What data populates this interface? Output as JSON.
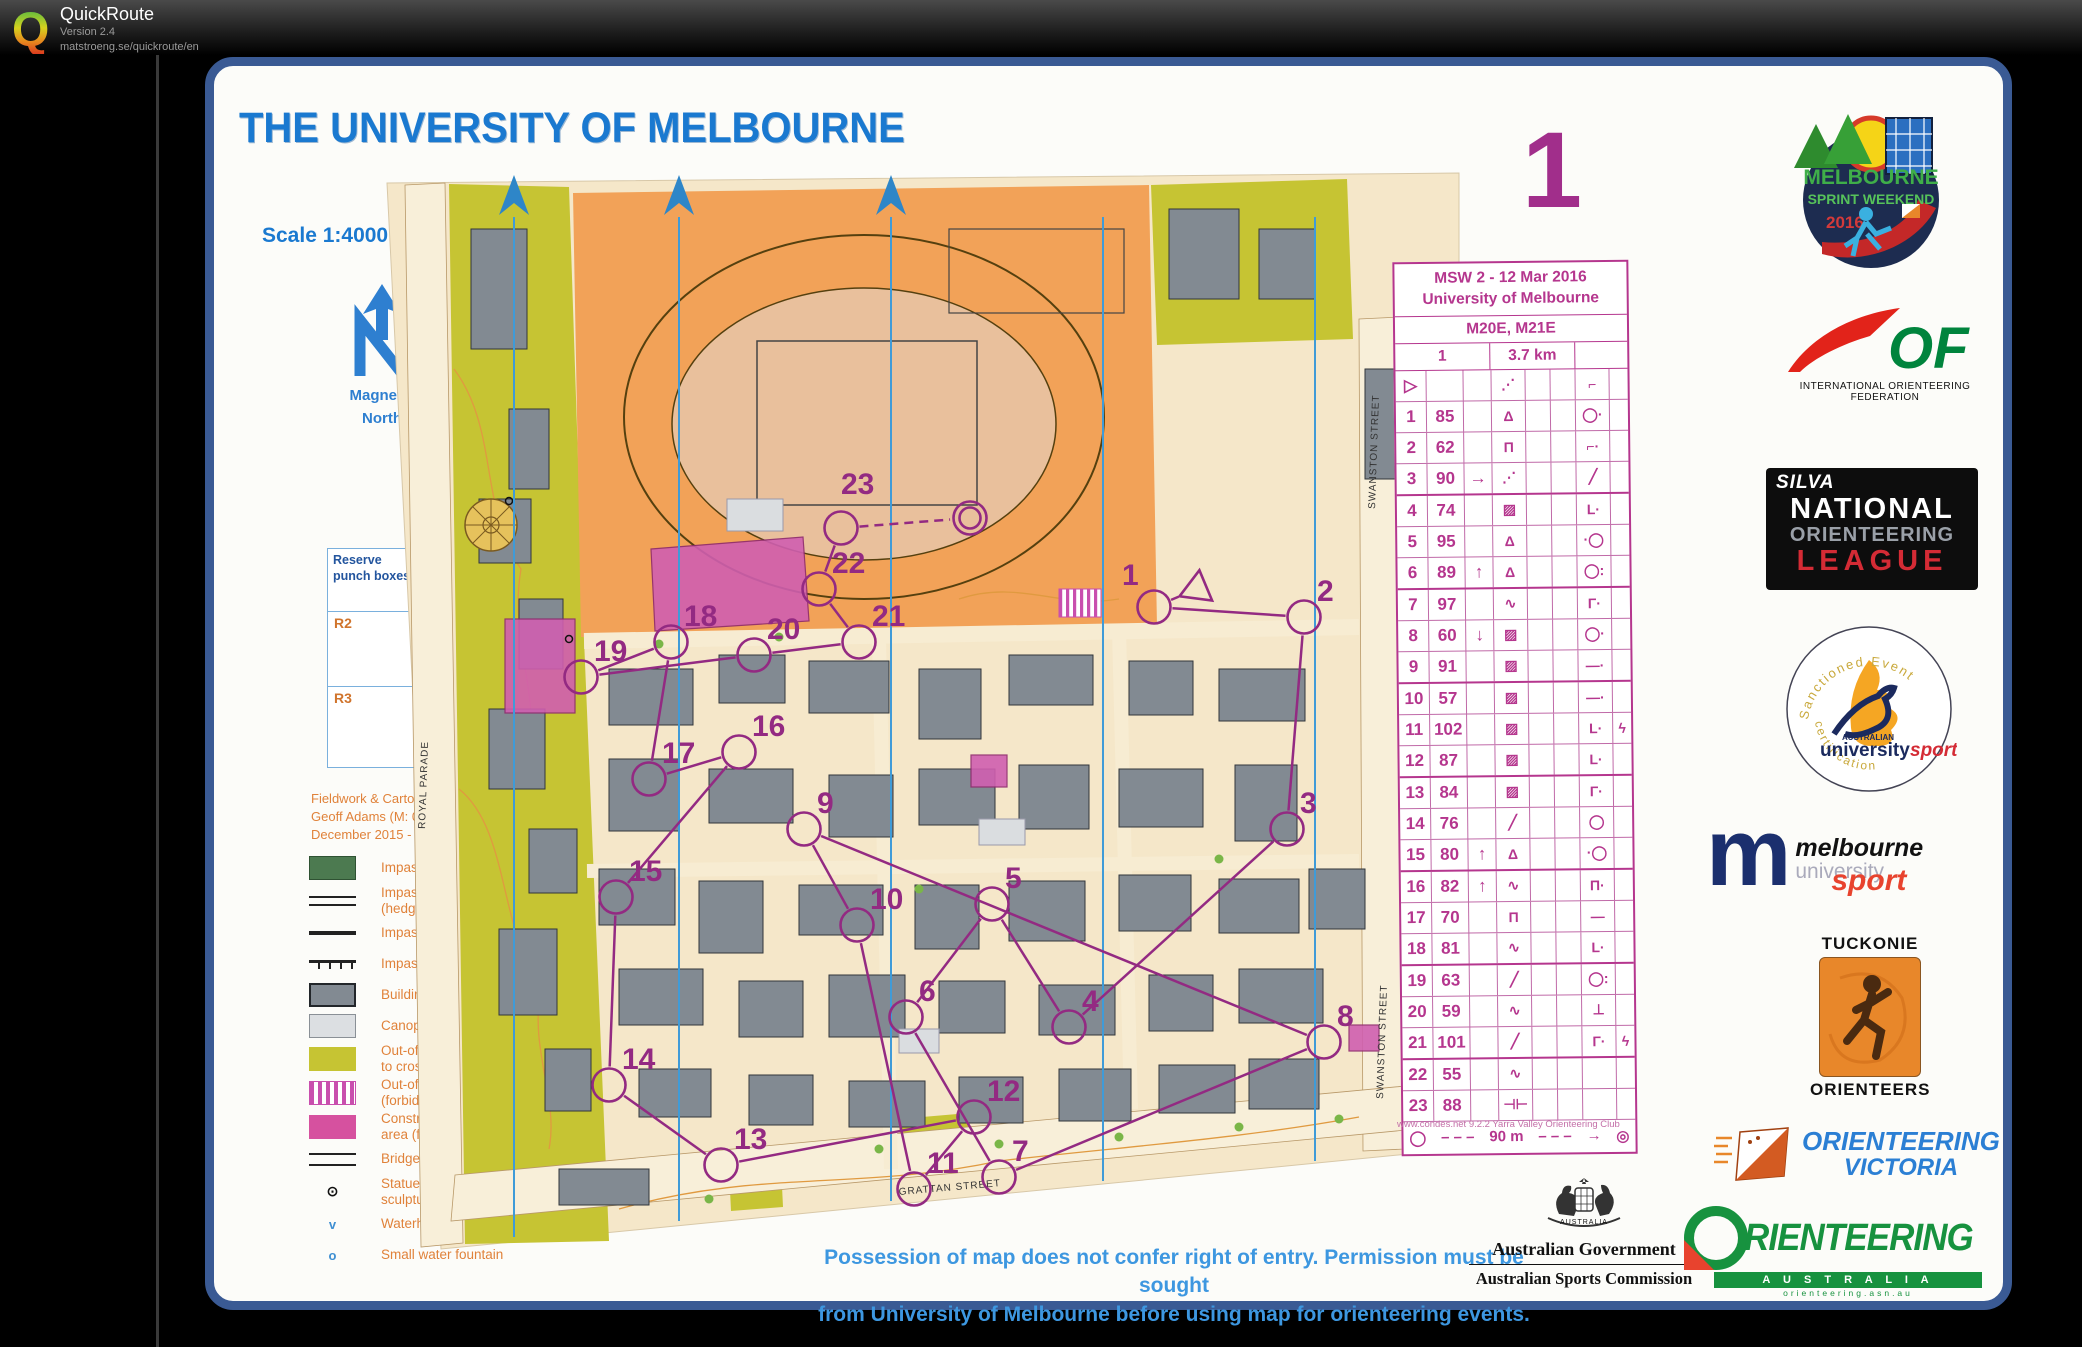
{
  "app": {
    "name": "QuickRoute",
    "version": "Version 2.4",
    "url": "matstroeng.se/quickroute/en",
    "logo_letter": "Q"
  },
  "map": {
    "title": "THE UNIVERSITY OF MELBOURNE",
    "scale": "Scale 1:4000",
    "contour": "Contour Interval 2m",
    "course_number": "1",
    "north": {
      "line1": "Magnetic",
      "line2": "North"
    },
    "scale_bar": {
      "ticks": [
        "0",
        "50",
        "100",
        "150"
      ]
    },
    "punch_box": {
      "title": "Reserve punch boxes",
      "slots": [
        "R2",
        "R3"
      ]
    },
    "credits": [
      "Fieldwork & Cartography",
      "Geoff Adams (M: 0418 587 941)",
      "December 2015 - March 2016"
    ],
    "legend": [
      {
        "symbol": "impassable-vegetation",
        "label": "Impassable vegetation"
      },
      {
        "symbol": "impassable-vegetation-hedge",
        "label": "Impassable vegetation (hedge)"
      },
      {
        "symbol": "impassable-wall",
        "label": "Impassable wall"
      },
      {
        "symbol": "impassable-fence",
        "label": "Impassable fence"
      },
      {
        "symbol": "building",
        "label": "Building (not passable)"
      },
      {
        "symbol": "canopy",
        "label": "Canopy (passable)"
      },
      {
        "symbol": "out-of-bounds",
        "label": "Out-of-bounds (forbidden to cross)"
      },
      {
        "symbol": "out-of-bounds-area",
        "label": "Out-of-bounds area (forbidden to enter)"
      },
      {
        "symbol": "construction",
        "label": "Construction or closed area (forbidden to enter)"
      },
      {
        "symbol": "bridge",
        "label": "Bridge"
      },
      {
        "symbol": "statue",
        "label": "Statue, monument, sculpture"
      },
      {
        "symbol": "waterhole",
        "label": "Waterhole"
      },
      {
        "symbol": "fountain",
        "label": "Small water fountain"
      }
    ],
    "streets": {
      "royal": "ROYAL PARADE",
      "swanston": "SWANSTON STREET",
      "grattan": "GRATTAN STREET"
    },
    "notice": {
      "line1": "Possession of map does not confer right of entry. Permission must be sought",
      "line2": "from University of Melbourne before using map for orienteering events."
    },
    "course": {
      "color": "#932a82",
      "points": [
        {
          "t": "start",
          "x": 838,
          "y": 420
        },
        {
          "t": "c",
          "n": "1",
          "x": 795,
          "y": 438,
          "lx": -32,
          "ly": -22
        },
        {
          "t": "c",
          "n": "2",
          "x": 945,
          "y": 448
        },
        {
          "t": "c",
          "n": "3",
          "x": 928,
          "y": 660
        },
        {
          "t": "c",
          "n": "4",
          "x": 710,
          "y": 858
        },
        {
          "t": "c",
          "n": "5",
          "x": 633,
          "y": 735
        },
        {
          "t": "c",
          "n": "6",
          "x": 547,
          "y": 848
        },
        {
          "t": "c",
          "n": "7",
          "x": 640,
          "y": 1008
        },
        {
          "t": "c",
          "n": "8",
          "x": 965,
          "y": 873
        },
        {
          "t": "c",
          "n": "9",
          "x": 445,
          "y": 660
        },
        {
          "t": "c",
          "n": "10",
          "x": 498,
          "y": 756
        },
        {
          "t": "c",
          "n": "11",
          "x": 555,
          "y": 1020
        },
        {
          "t": "c",
          "n": "12",
          "x": 615,
          "y": 948
        },
        {
          "t": "c",
          "n": "13",
          "x": 362,
          "y": 996
        },
        {
          "t": "c",
          "n": "14",
          "x": 250,
          "y": 916
        },
        {
          "t": "c",
          "n": "15",
          "x": 257,
          "y": 728
        },
        {
          "t": "c",
          "n": "16",
          "x": 380,
          "y": 583
        },
        {
          "t": "c",
          "n": "17",
          "x": 290,
          "y": 610
        },
        {
          "t": "c",
          "n": "18",
          "x": 312,
          "y": 473
        },
        {
          "t": "c",
          "n": "19",
          "x": 222,
          "y": 508
        },
        {
          "t": "c",
          "n": "20",
          "x": 395,
          "y": 486
        },
        {
          "t": "c",
          "n": "21",
          "x": 500,
          "y": 473
        },
        {
          "t": "c",
          "n": "22",
          "x": 460,
          "y": 420
        },
        {
          "t": "c",
          "n": "23",
          "x": 482,
          "y": 359,
          "lx": 0,
          "ly": -34,
          "dashNext": true
        },
        {
          "t": "finish",
          "x": 611,
          "y": 349
        }
      ]
    }
  },
  "control_card": {
    "title1": "MSW 2 - 12 Mar 2016",
    "title2": "University of Melbourne",
    "classes": "M20E, M21E",
    "course": "1",
    "length": "3.7 km",
    "rows": [
      {
        "a": "▷",
        "b": "",
        "c": "",
        "d": "⋰",
        "e": "",
        "f": "",
        "g": "⌐",
        "h": ""
      },
      {
        "a": "1",
        "b": "85",
        "c": "",
        "d": "Δ",
        "e": "",
        "f": "",
        "g": "◯·",
        "h": ""
      },
      {
        "a": "2",
        "b": "62",
        "c": "",
        "d": "Π",
        "e": "",
        "f": "",
        "g": "⌐·",
        "h": ""
      },
      {
        "a": "3",
        "b": "90",
        "c": "→",
        "d": "⋰",
        "e": "",
        "f": "",
        "g": "╱",
        "h": ""
      },
      {
        "a": "4",
        "b": "74",
        "c": "",
        "d": "▨",
        "e": "",
        "f": "",
        "g": "L·",
        "h": ""
      },
      {
        "a": "5",
        "b": "95",
        "c": "",
        "d": "Δ",
        "e": "",
        "f": "",
        "g": "·◯",
        "h": ""
      },
      {
        "a": "6",
        "b": "89",
        "c": "↑",
        "d": "Δ",
        "e": "",
        "f": "",
        "g": "◯:",
        "h": ""
      },
      {
        "a": "7",
        "b": "97",
        "c": "",
        "d": "∿",
        "e": "",
        "f": "",
        "g": "Γ·",
        "h": ""
      },
      {
        "a": "8",
        "b": "60",
        "c": "↓",
        "d": "▨",
        "e": "",
        "f": "",
        "g": "◯·",
        "h": ""
      },
      {
        "a": "9",
        "b": "91",
        "c": "",
        "d": "▨",
        "e": "",
        "f": "",
        "g": "—·",
        "h": ""
      },
      {
        "a": "10",
        "b": "57",
        "c": "",
        "d": "▨",
        "e": "",
        "f": "",
        "g": "—·",
        "h": ""
      },
      {
        "a": "11",
        "b": "102",
        "c": "",
        "d": "▨",
        "e": "",
        "f": "",
        "g": "L·",
        "h": "ϟ"
      },
      {
        "a": "12",
        "b": "87",
        "c": "",
        "d": "▨",
        "e": "",
        "f": "",
        "g": "L·",
        "h": ""
      },
      {
        "a": "13",
        "b": "84",
        "c": "",
        "d": "▨",
        "e": "",
        "f": "",
        "g": "Γ·",
        "h": ""
      },
      {
        "a": "14",
        "b": "76",
        "c": "",
        "d": "╱",
        "e": "",
        "f": "",
        "g": "◯",
        "h": ""
      },
      {
        "a": "15",
        "b": "80",
        "c": "↑",
        "d": "Δ",
        "e": "",
        "f": "",
        "g": "·◯",
        "h": ""
      },
      {
        "a": "16",
        "b": "82",
        "c": "↑",
        "d": "∿",
        "e": "",
        "f": "",
        "g": "Π·",
        "h": ""
      },
      {
        "a": "17",
        "b": "70",
        "c": "",
        "d": "Π",
        "e": "",
        "f": "",
        "g": "—",
        "h": ""
      },
      {
        "a": "18",
        "b": "81",
        "c": "",
        "d": "∿",
        "e": "",
        "f": "",
        "g": "L·",
        "h": ""
      },
      {
        "a": "19",
        "b": "63",
        "c": "",
        "d": "╱",
        "e": "",
        "f": "",
        "g": "◯:",
        "h": ""
      },
      {
        "a": "20",
        "b": "59",
        "c": "",
        "d": "∿",
        "e": "",
        "f": "",
        "g": "⊥",
        "h": ""
      },
      {
        "a": "21",
        "b": "101",
        "c": "",
        "d": "╱",
        "e": "",
        "f": "",
        "g": "Γ·",
        "h": "ϟ"
      },
      {
        "a": "22",
        "b": "55",
        "c": "",
        "d": "∿",
        "e": "",
        "f": "",
        "g": "",
        "h": ""
      },
      {
        "a": "23",
        "b": "88",
        "c": "",
        "d": "⊣⊢",
        "e": "",
        "f": "",
        "g": "",
        "h": ""
      }
    ],
    "finish": {
      "start_glyph": "◯",
      "dash1": "– – –",
      "label": "90 m",
      "dash2": "– – –",
      "arrow": "→",
      "end_glyph": "◎"
    },
    "credit": "www.condes.net 9.2.2 Yarra Valley Orienteering Club"
  },
  "logos": {
    "msw": {
      "l1": "MELBOURNE",
      "l2": "SPRINT WEEKEND",
      "l3": "2016"
    },
    "iof": {
      "letters": "OF",
      "caption": "INTERNATIONAL ORIENTEERING FEDERATION"
    },
    "silva": {
      "brand": "SILVA",
      "l1": "NATIONAL",
      "l2": "ORIENTEERING",
      "l3": "LEAGUE"
    },
    "unisport": {
      "arc_top": "Sanctioned Event",
      "l1": "AUSTRALIAN",
      "l2": "university",
      "l3": "sport",
      "arc_bottom": "certification"
    },
    "musport": {
      "m": "m",
      "l1": "melbourne",
      "l2": "university",
      "l3": "sport"
    },
    "tuckonie": {
      "top": "TUCKONIE",
      "bottom": "ORIENTEERS"
    },
    "ov": {
      "l1": "ORIENTEERING",
      "l2": "VICTORIA"
    },
    "oa": {
      "o": "O",
      "word": "RIENTEERING",
      "bar": "A U S T R A L I A",
      "url": "orienteering.asn.au"
    },
    "gov": {
      "shield": "AUSTRALIA",
      "l1": "Australian Government",
      "l2": "Australian Sports Commission"
    }
  }
}
